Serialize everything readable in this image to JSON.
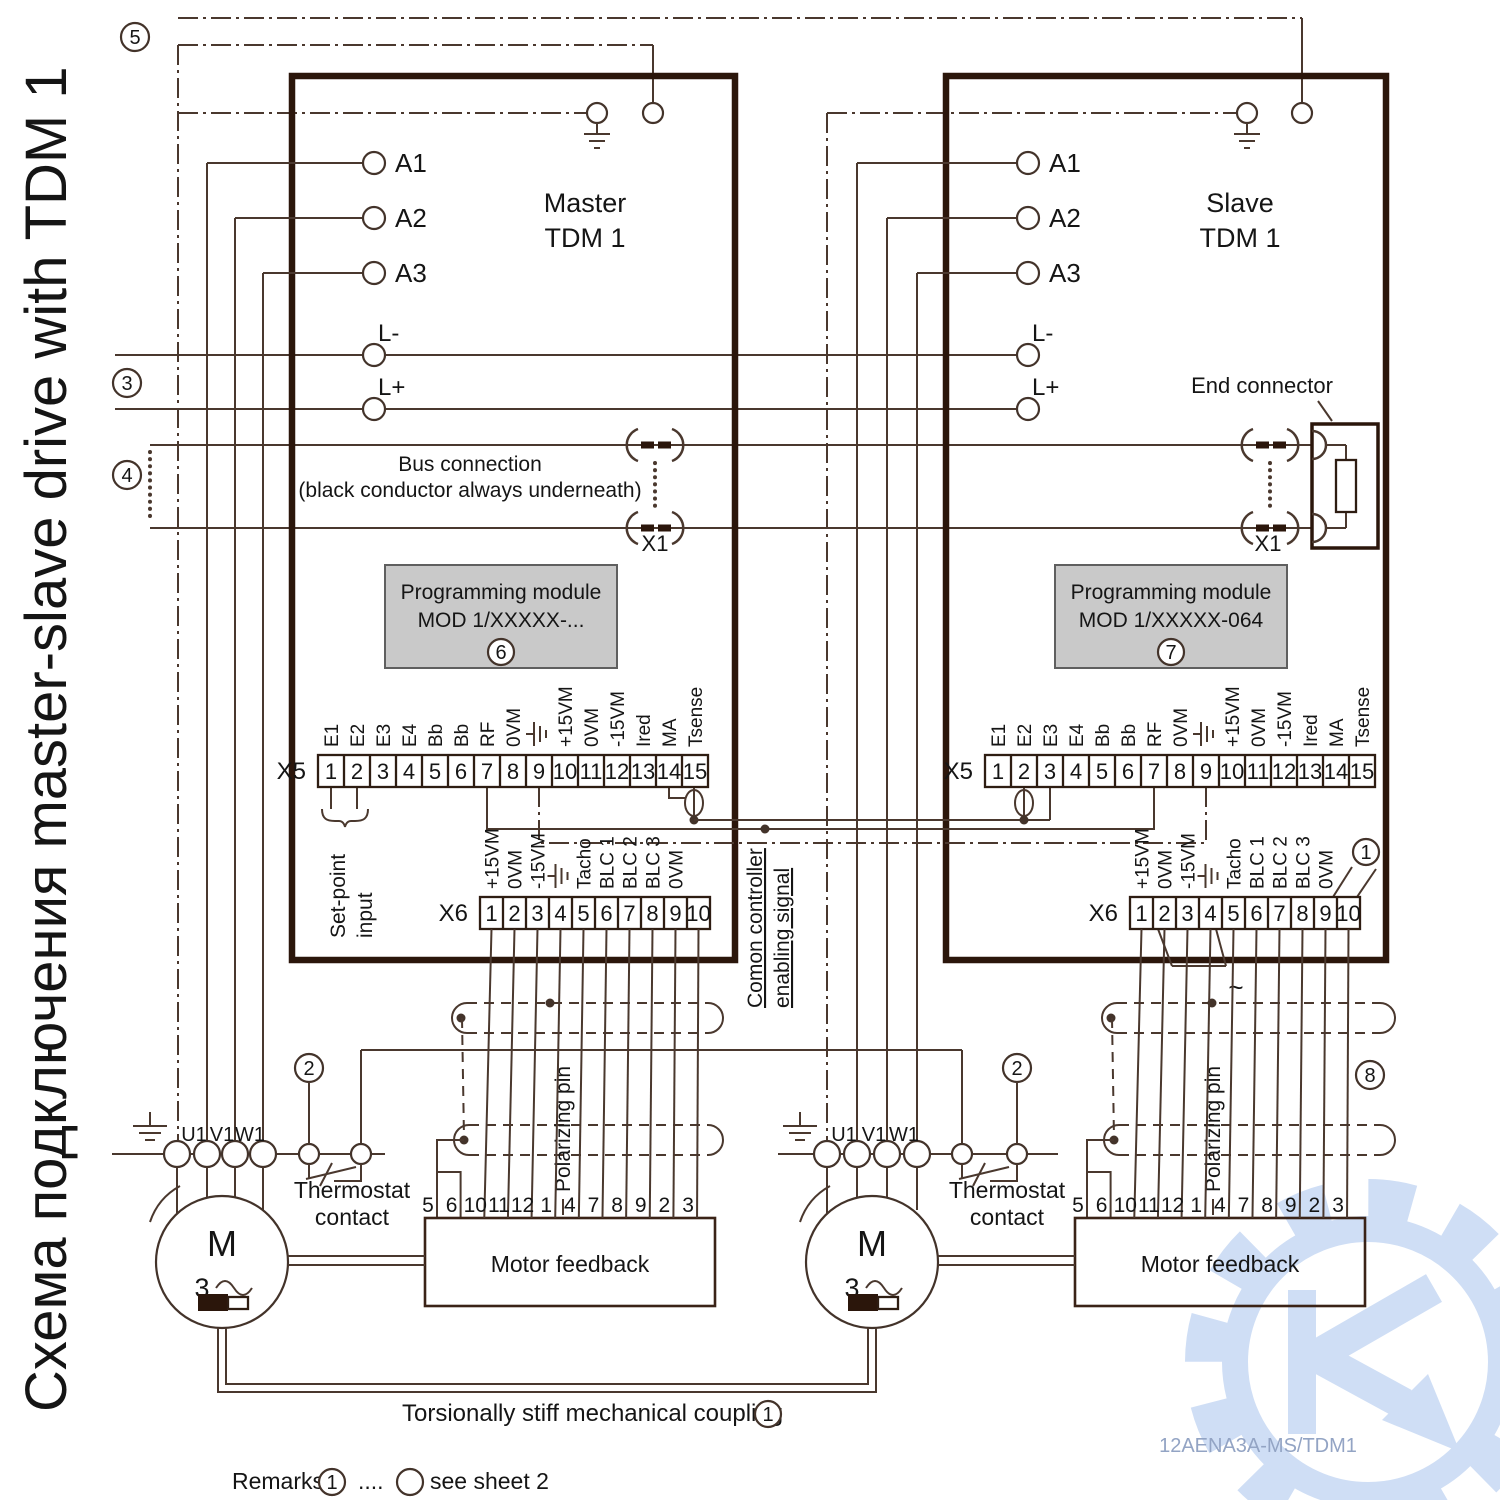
{
  "title": "Схема подключения master-slave drive with TDM 1",
  "colors": {
    "line": "#4a382e",
    "thick_border": "#2b160b",
    "module_fill": "#c9c9c9",
    "watermark": "#cfdef5",
    "docnum": "#93a4c4"
  },
  "badges": [
    "1",
    "2",
    "3",
    "4",
    "5",
    "6",
    "7",
    "8"
  ],
  "boxes": {
    "master": {
      "line1": "Master",
      "line2": "TDM 1"
    },
    "slave": {
      "line1": "Slave",
      "line2": "TDM 1"
    }
  },
  "modules": {
    "title": "Programming module",
    "master_model": "MOD 1/XXXXX-...",
    "slave_model": "MOD 1/XXXXX-064"
  },
  "terminals": {
    "a1": "A1",
    "a2": "A2",
    "a3": "A3",
    "lminus": "L-",
    "lplus": "L+",
    "u": "U1",
    "v": "V1",
    "w": "W1"
  },
  "bus": {
    "note1": "Bus connection",
    "note2": "(black conductor always underneath)",
    "x1": "X1",
    "end_connector": "End connector"
  },
  "x5": {
    "name": "X5",
    "pins": [
      "1",
      "2",
      "3",
      "4",
      "5",
      "6",
      "7",
      "8",
      "9",
      "10",
      "11",
      "12",
      "13",
      "14",
      "15"
    ],
    "labels": [
      "E1",
      "E2",
      "E3",
      "E4",
      "Bb",
      "Bb",
      "RF",
      "0VM",
      "",
      "+15VM",
      "0VM",
      "-15VM",
      "Ired",
      "MA",
      "Tsense"
    ]
  },
  "x6": {
    "name": "X6",
    "pins": [
      "1",
      "2",
      "3",
      "4",
      "5",
      "6",
      "7",
      "8",
      "9",
      "10"
    ],
    "labels": [
      "+15VM",
      "0VM",
      "-15VM",
      "",
      "Tacho",
      "BLC 1",
      "BLC 2",
      "BLC 3",
      "0VM",
      ""
    ]
  },
  "setpoint": {
    "line1": "Set-point",
    "line2": "input"
  },
  "controller": {
    "line1": "Comon controller",
    "line2": "enabling signal"
  },
  "feedback": {
    "label": "Motor feedback",
    "pins": [
      "5",
      "6",
      "10",
      "11",
      "12",
      "1",
      "4",
      "7",
      "8",
      "9",
      "2",
      "3"
    ]
  },
  "polarizing": "Polarizing pin",
  "thermostat": {
    "line1": "Thermostat",
    "line2": "contact"
  },
  "motor": {
    "m": "M",
    "phase": "3"
  },
  "tilde": "~",
  "footer": {
    "coupling": "Torsionally stiff mechanical coupling",
    "remarks": "Remarks",
    "dots": "....",
    "see": "see sheet 2",
    "docnum": "12AENA3A-MS/TDM1"
  }
}
